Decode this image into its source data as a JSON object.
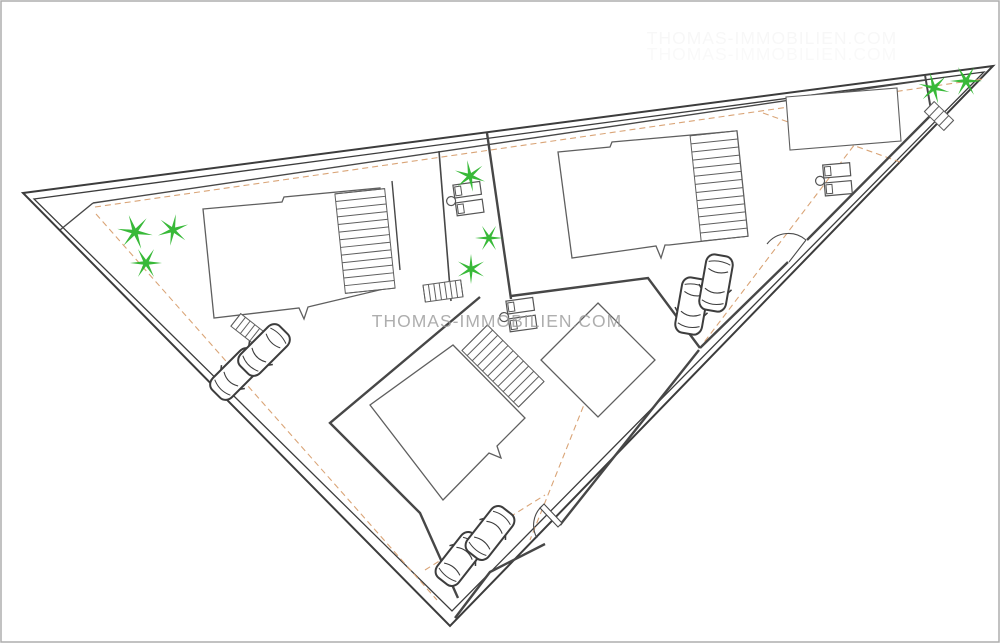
{
  "watermark": {
    "text": "THOMAS-IMMOBILIEN.COM",
    "x": 497,
    "y": 327,
    "font_size": 17.5,
    "letter_spacing": 1,
    "opacity": 0.8,
    "echoes": [
      {
        "x": 772,
        "y": 44,
        "opacity": 0.07
      },
      {
        "x": 772,
        "y": 60,
        "opacity": 0.05
      }
    ]
  },
  "colors": {
    "background": "#ffffff",
    "frame": "#adadad",
    "boundary": "#3c3c3c",
    "wall": "#474747",
    "building_stroke": "#5f5f5f",
    "setback": "#d8a070",
    "tree": "#2db52d",
    "car_stroke": "#3d3d3d",
    "watermark": "#9a9a9a"
  },
  "site": {
    "summary": {
      "parcels": 3,
      "buildings": 3,
      "trees": 8,
      "cars": 6,
      "sunbed_groups": 3,
      "stair_flights": 6,
      "gates": 2,
      "pool": 1
    },
    "trees": [
      {
        "x": 135,
        "y": 232,
        "r": 18,
        "rot": 10
      },
      {
        "x": 173,
        "y": 230,
        "r": 16,
        "rot": 40
      },
      {
        "x": 146,
        "y": 263,
        "r": 16,
        "rot": 0
      },
      {
        "x": 470,
        "y": 176,
        "r": 16,
        "rot": 20
      },
      {
        "x": 489,
        "y": 238,
        "r": 14,
        "rot": 0
      },
      {
        "x": 471,
        "y": 269,
        "r": 15,
        "rot": 30
      },
      {
        "x": 934,
        "y": 88,
        "r": 16,
        "rot": 15
      },
      {
        "x": 966,
        "y": 81,
        "r": 16,
        "rot": 0
      }
    ],
    "cars": [
      {
        "x": 236,
        "y": 374,
        "rot": 225
      },
      {
        "x": 264,
        "y": 350,
        "rot": 225
      },
      {
        "x": 692,
        "y": 306,
        "rot": 190
      },
      {
        "x": 716,
        "y": 283,
        "rot": 190
      },
      {
        "x": 460,
        "y": 559,
        "rot": 38
      },
      {
        "x": 490,
        "y": 533,
        "rot": 38
      }
    ],
    "furniture": [
      {
        "x": 455,
        "y": 200,
        "rot": -8
      },
      {
        "x": 508,
        "y": 316,
        "rot": -8
      },
      {
        "x": 824,
        "y": 180,
        "rot": -5
      }
    ],
    "hatch_bands": [
      {
        "cx": 365,
        "cy": 241,
        "len": 100,
        "wid": 50,
        "rot": 84,
        "steps": 14
      },
      {
        "cx": 719,
        "cy": 186,
        "len": 106,
        "wid": 47,
        "rot": 84,
        "steps": 14
      },
      {
        "cx": 503,
        "cy": 366,
        "len": 80,
        "wid": 36,
        "rot": 45,
        "steps": 12
      },
      {
        "cx": 443,
        "cy": 291,
        "len": 38,
        "wid": 17,
        "rot": -8,
        "steps": 8
      },
      {
        "cx": 250,
        "cy": 331,
        "len": 36,
        "wid": 16,
        "rot": 38,
        "steps": 7
      },
      {
        "cx": 939,
        "cy": 116,
        "len": 27,
        "wid": 14,
        "rot": 44,
        "steps": 5
      }
    ],
    "setback_lines": [
      {
        "x1": 95,
        "y1": 207,
        "x2": 983,
        "y2": 79
      },
      {
        "x1": 96,
        "y1": 214,
        "x2": 437,
        "y2": 600
      },
      {
        "x1": 890,
        "y1": 98,
        "x2": 702,
        "y2": 345
      },
      {
        "x1": 763,
        "y1": 113,
        "x2": 900,
        "y2": 162
      },
      {
        "x1": 613,
        "y1": 332,
        "x2": 530,
        "y2": 540
      },
      {
        "x1": 425,
        "y1": 570,
        "x2": 545,
        "y2": 495
      }
    ]
  },
  "symbols": {
    "tree": "six-point-palm-star",
    "car": "car-top-view",
    "furniture": "two-sunbeds-with-round-table",
    "stairs": "hatched-stair-band",
    "gate": "door-swing-arc"
  }
}
